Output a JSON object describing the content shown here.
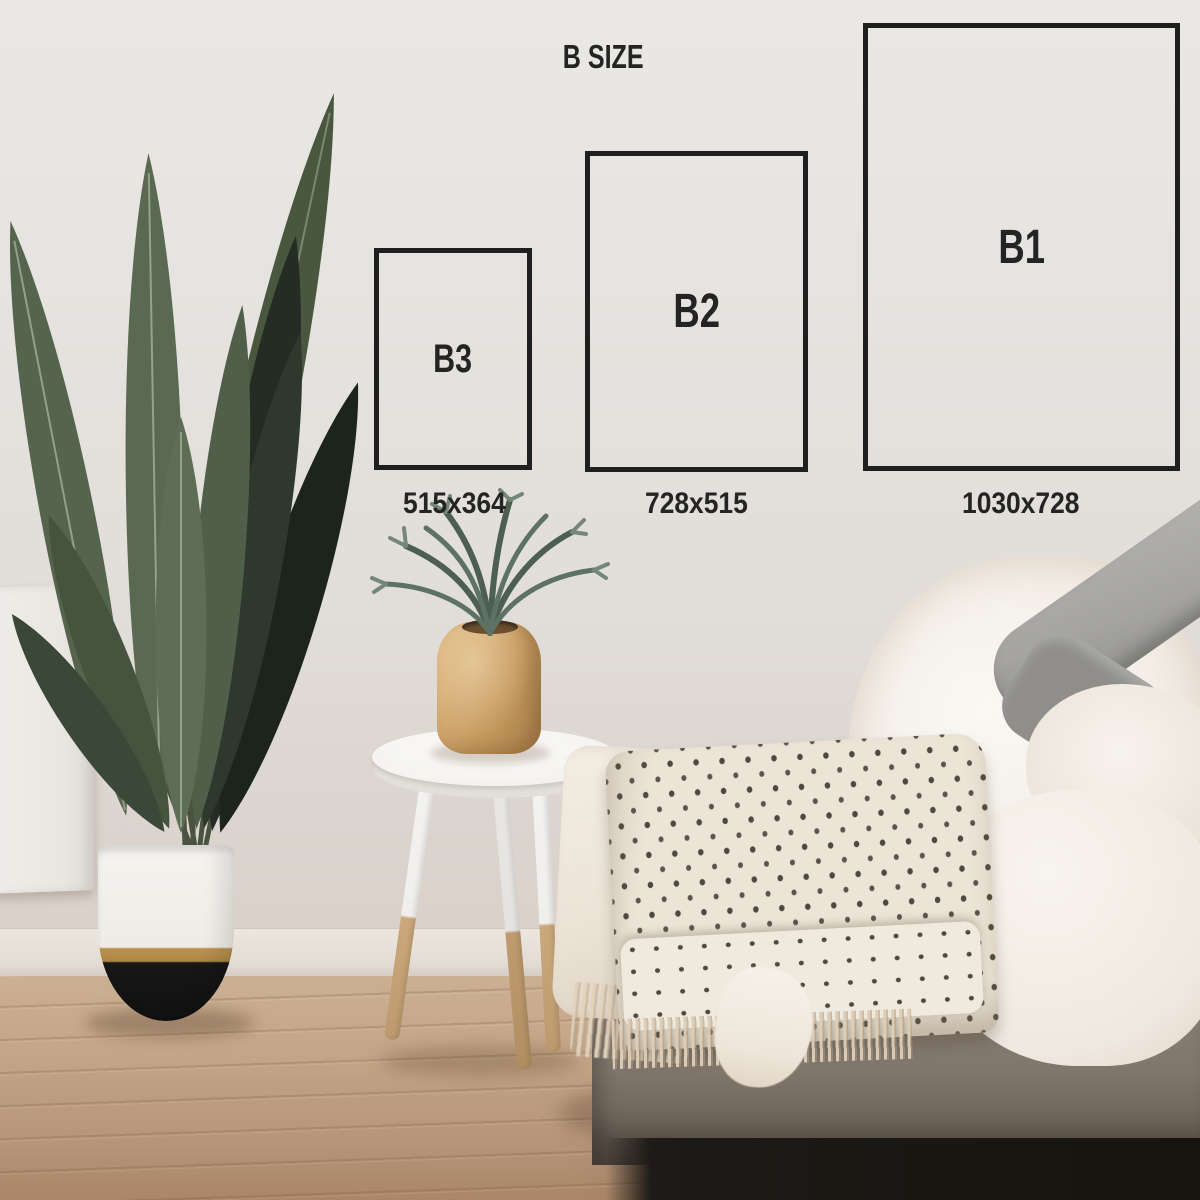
{
  "diagram": {
    "title": "B SIZE",
    "frame_color": "#1f1f1f",
    "text_color": "#242424",
    "sizes": [
      {
        "name": "B3",
        "dimensions": "515x364"
      },
      {
        "name": "B2",
        "dimensions": "728x515"
      },
      {
        "name": "B1",
        "dimensions": "1030x728"
      }
    ]
  }
}
